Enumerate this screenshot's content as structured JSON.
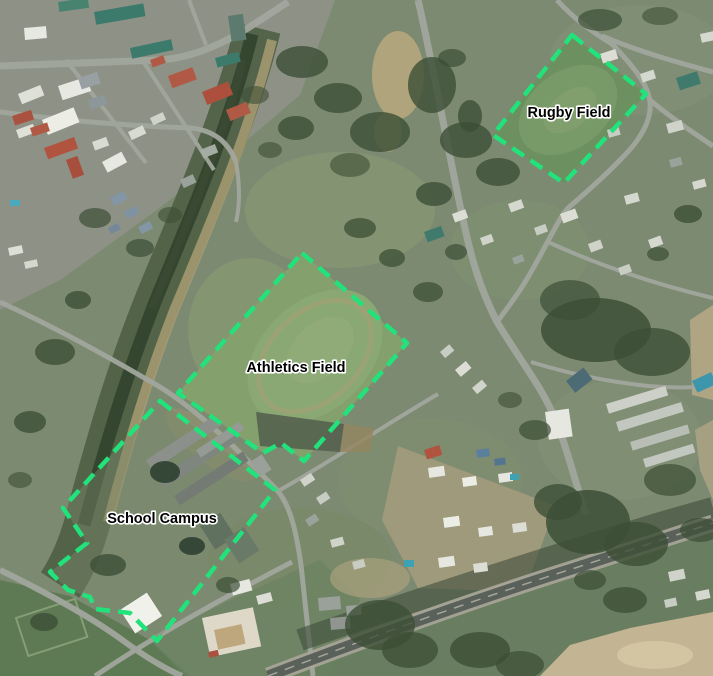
{
  "map": {
    "type": "aerial-satellite-map",
    "canvas": {
      "width": 713,
      "height": 676
    },
    "overlay": {
      "outline_color": "#21e27b",
      "label_color": "#000000",
      "label_halo_color": "#ffffff",
      "polygons": [
        {
          "name": "rugby-field",
          "label": "Rugby Field",
          "label_x": 569,
          "label_y": 117,
          "points": [
            [
              572,
              35
            ],
            [
              646,
              94
            ],
            [
              564,
              183
            ],
            [
              493,
              135
            ]
          ]
        },
        {
          "name": "athletics-field",
          "label": "Athletics Field",
          "label_x": 296,
          "label_y": 372,
          "points": [
            [
              302,
              253
            ],
            [
              407,
              343
            ],
            [
              304,
              461
            ],
            [
              281,
              443
            ],
            [
              263,
              453
            ],
            [
              178,
              393
            ]
          ]
        },
        {
          "name": "school-campus",
          "label": "School Campus",
          "label_x": 162,
          "label_y": 523,
          "points": [
            [
              160,
              401
            ],
            [
              275,
              490
            ],
            [
              157,
              641
            ],
            [
              130,
              613
            ],
            [
              95,
              609
            ],
            [
              90,
              597
            ],
            [
              68,
              590
            ],
            [
              50,
              572
            ],
            [
              87,
              543
            ],
            [
              63,
              508
            ]
          ]
        }
      ]
    }
  }
}
